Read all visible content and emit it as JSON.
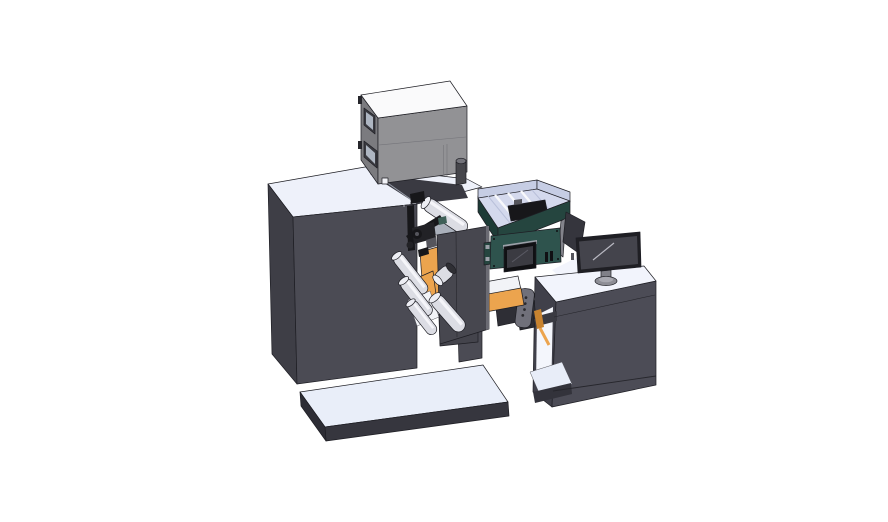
{
  "scene": {
    "type": "3d-cad-render",
    "subject": "label printing press with unwind unit, electrical cabinet, HMI touchscreen, conveyor bridge and operator desk with monitor",
    "background": "#ffffff"
  },
  "colors": {
    "background": "#ffffff",
    "edge": "#1e1e24",
    "seam": "#9aa0ac",
    "seam_dark": "#26262c",
    "body_front": "#4b4b54",
    "body_left": "#3e3e46",
    "body_top": "#eef1fa",
    "notch_wall": "#3a3a42",
    "slab": "#44444c",
    "base_top": "#e9eef9",
    "base_front": "#36363e",
    "base_left": "#2d2d35",
    "cabinet_front": "#929295",
    "cabinet_left": "#7b7b7f",
    "cabinet_top": "#fafafb",
    "cabinet_window": "#3a3a40",
    "cabinet_window_inner": "#aeb6c2",
    "cabinet_detail": "#74747a",
    "cabinet_knob": "#46464b",
    "cabinet_knob_top": "#73737a",
    "hinge": "#26262b",
    "roller_body": "#dcdde4",
    "roller_highlight": "#f5f5f9",
    "roller_face": "#edeef4",
    "roller_cap": "#2f2f34",
    "orange": "#eca44e",
    "orange_dark": "#c8832f",
    "plate": "#47474f",
    "plate_edge": "#6b6b73",
    "head_black": "#17171a",
    "head_block": "#222226",
    "head_gray": "#55555c",
    "head_teal": "#3f6058",
    "chute": "#aab0bb",
    "tray_top": "#d4d9ed",
    "tray_wall": "#c6cde4",
    "tray_bar": "#f8f9fc",
    "tray_divider": "#b9c0da",
    "tray_teal": "#25453f",
    "tray_teal_dark": "#1d3b36",
    "magenta": "#c257c0",
    "hmi_teal": "#2e534d",
    "hmi_highlight": "#9ba0a8",
    "screen_bezel": "#101013",
    "screen_face": "#3b3b42",
    "screen_shine": "#5a5a64",
    "sail": "#35353d",
    "sail_strip": "#83838b",
    "monitor_bezel": "#1f1f24",
    "monitor_screen": "#44444c",
    "monitor_shine": "#b9b9c2",
    "monitor_stand": "#808088",
    "monitor_base": "#8d8d95",
    "monitor_base_top": "#a8a8b0",
    "desk_front": "#4c4c56",
    "desk_left": "#40404a",
    "desk_top": "#f2f4fc",
    "desk_cavity": "#f4f6fc",
    "desk_floor": "#e8edf8",
    "underfloor": "#33333b",
    "cavity_bar": "#3a3a42",
    "bridge_dark": "#2e2e35",
    "bracket": "#70707a",
    "bracket_hole": "#2b2b30",
    "foot_dark": "#2b2b31",
    "white_part": "#f2f3f7",
    "panel_dot": "#82828a"
  },
  "parts": [
    "machine-base-platform",
    "main-housing",
    "control-cabinet",
    "unwind-web-unit",
    "print-head-mechanism",
    "feed-tray",
    "hmi-touch-panel",
    "conveyor-bridge",
    "outfeed-ramp",
    "operator-desk",
    "desktop-monitor",
    "deflector-panel"
  ]
}
